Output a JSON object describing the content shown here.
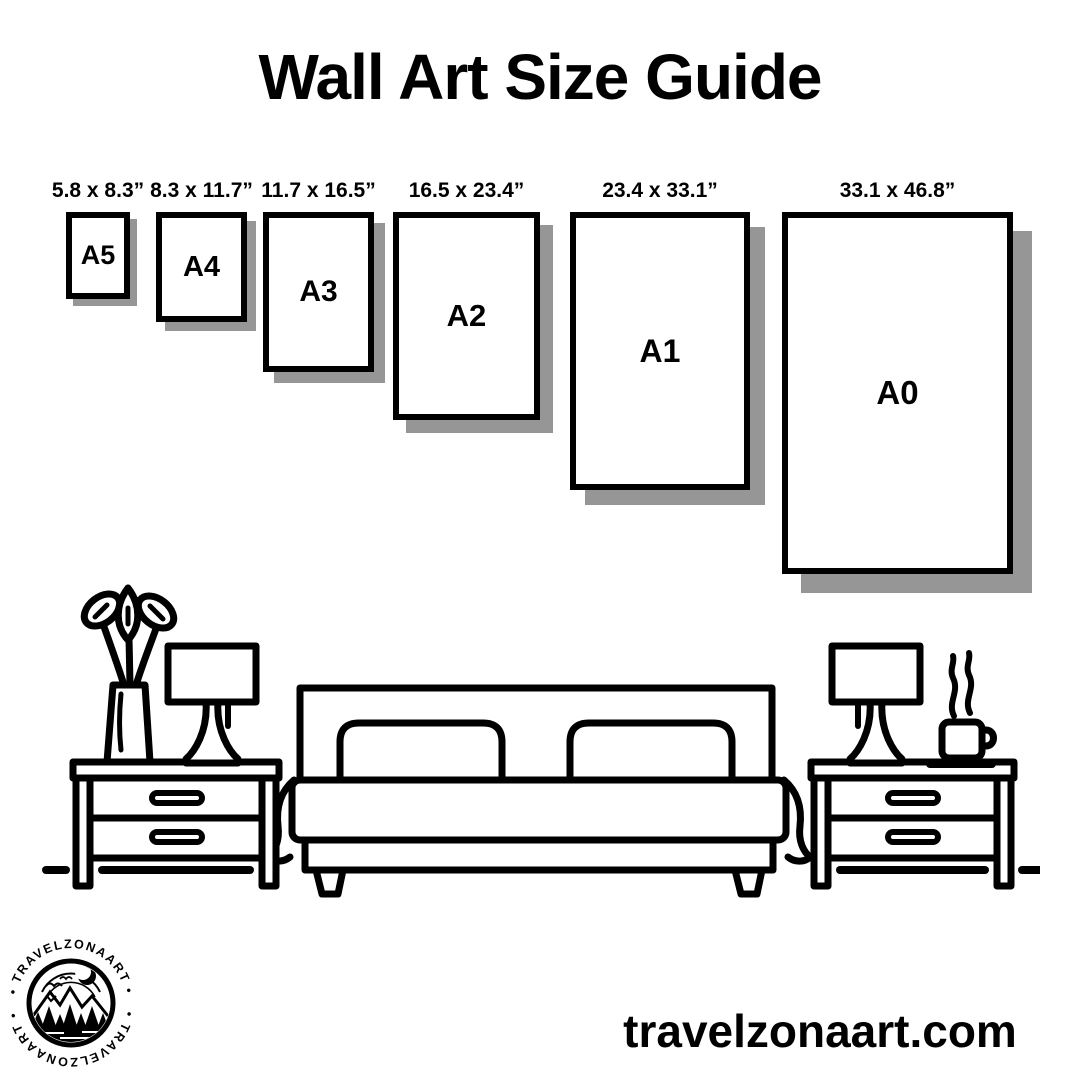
{
  "title": "Wall Art Size Guide",
  "sizes": [
    {
      "label": "A5",
      "dimensions": "5.8 x 8.3”"
    },
    {
      "label": "A4",
      "dimensions": "8.3 x 11.7”"
    },
    {
      "label": "A3",
      "dimensions": "11.7 x 16.5”"
    },
    {
      "label": "A2",
      "dimensions": "16.5 x 23.4”"
    },
    {
      "label": "A1",
      "dimensions": "23.4 x 33.1”"
    },
    {
      "label": "A0",
      "dimensions": "33.1 x 46.8”"
    }
  ],
  "logo": {
    "text_top": "• TRAVELZONAART •",
    "text_bottom": "• TRAVELZONAART •"
  },
  "footer": {
    "website": "travelzonaart.com"
  },
  "colors": {
    "ink": "#000000",
    "shadow": "#969696",
    "background": "#ffffff"
  }
}
